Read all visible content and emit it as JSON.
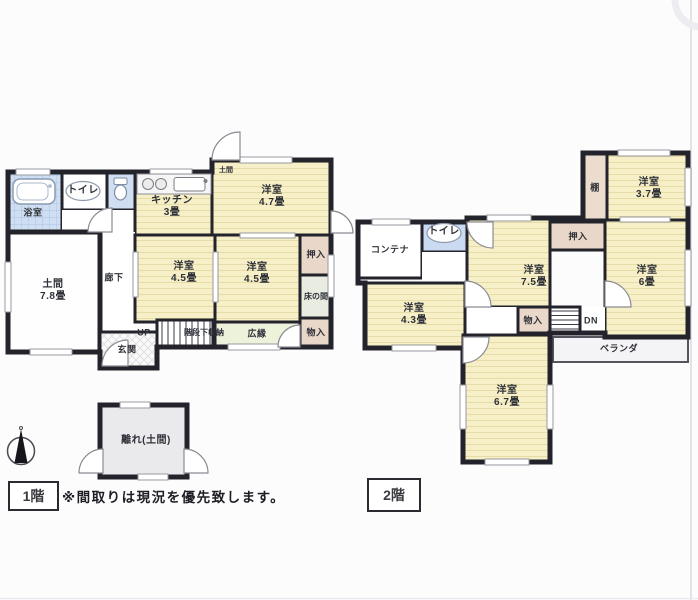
{
  "canvas": {
    "background": "#fcfcfd",
    "wall_color": "#23232b",
    "room_fill": "#f7efc7",
    "closet_fill": "#e9d7c9",
    "bath_fill": "#cfdff1",
    "tokonoma_fill": "#e9ece0",
    "hiroen_fill": "#edf2da",
    "veranda_fill": "#f4f4f6",
    "annex_fill": "#eaeaec"
  },
  "floor1": {
    "tag": "1階",
    "labels": {
      "bath": "浴室",
      "toilet": "トイレ",
      "kitchen": "キッチン\n3畳",
      "room_4_7": "洋室\n4.7畳",
      "doma_entry": "土間",
      "corridor": "廊下",
      "doma": "土間\n7.8畳",
      "room_4_5_left": "洋室\n4.5畳",
      "room_4_5_right": "洋室\n4.5畳",
      "oshiire": "押入",
      "tokonoma": "床の間",
      "hiroen": "広縁",
      "monoire": "物入",
      "up": "UP",
      "stair_storage": "階段下収納",
      "genkan": "玄関"
    }
  },
  "floor2": {
    "tag": "2階",
    "labels": {
      "container": "コンテナ",
      "toilet": "トイレ",
      "room_7_5": "洋室\n7.5畳",
      "oshiire": "押入",
      "shelf": "棚",
      "room_3_7": "洋室\n3.7畳",
      "room_6": "洋室\n6畳",
      "monoire": "物入",
      "dn": "DN",
      "veranda": "ベランダ",
      "room_4_3": "洋室\n4.3畳",
      "room_6_7": "洋室\n6.7畳"
    }
  },
  "annex": {
    "label": "離れ(土間)"
  },
  "note": "※間取りは現況を優先致します。"
}
